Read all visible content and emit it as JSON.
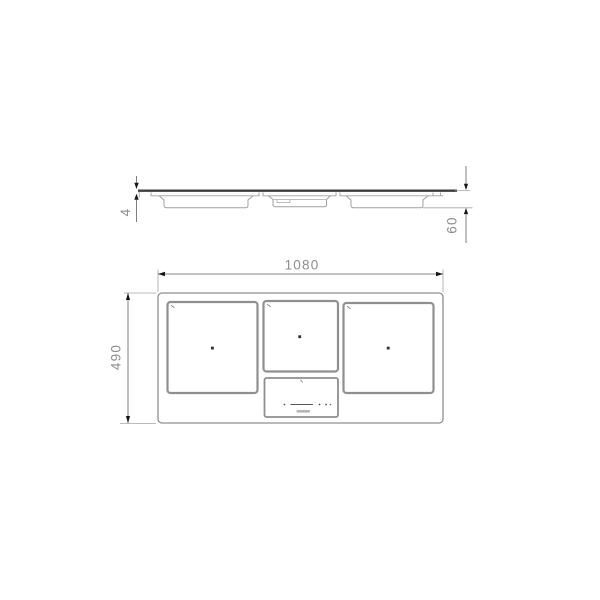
{
  "drawing_type": "cooktop-installation-dimensions",
  "colors": {
    "background": "#ffffff",
    "outline_gray": "#8f8f8f",
    "light_line": "#a5a5a5",
    "glass_dark": "#3d3d3d",
    "dimension_line": "#5f5f5f",
    "dimension_text": "#8e8e8e",
    "arrow": "#161616",
    "detail_mark": "#555555"
  },
  "side_view": {
    "glass_thickness_label": "4",
    "built_in_depth_label": "60"
  },
  "top_view": {
    "width_label": "1080",
    "depth_label": "490"
  }
}
